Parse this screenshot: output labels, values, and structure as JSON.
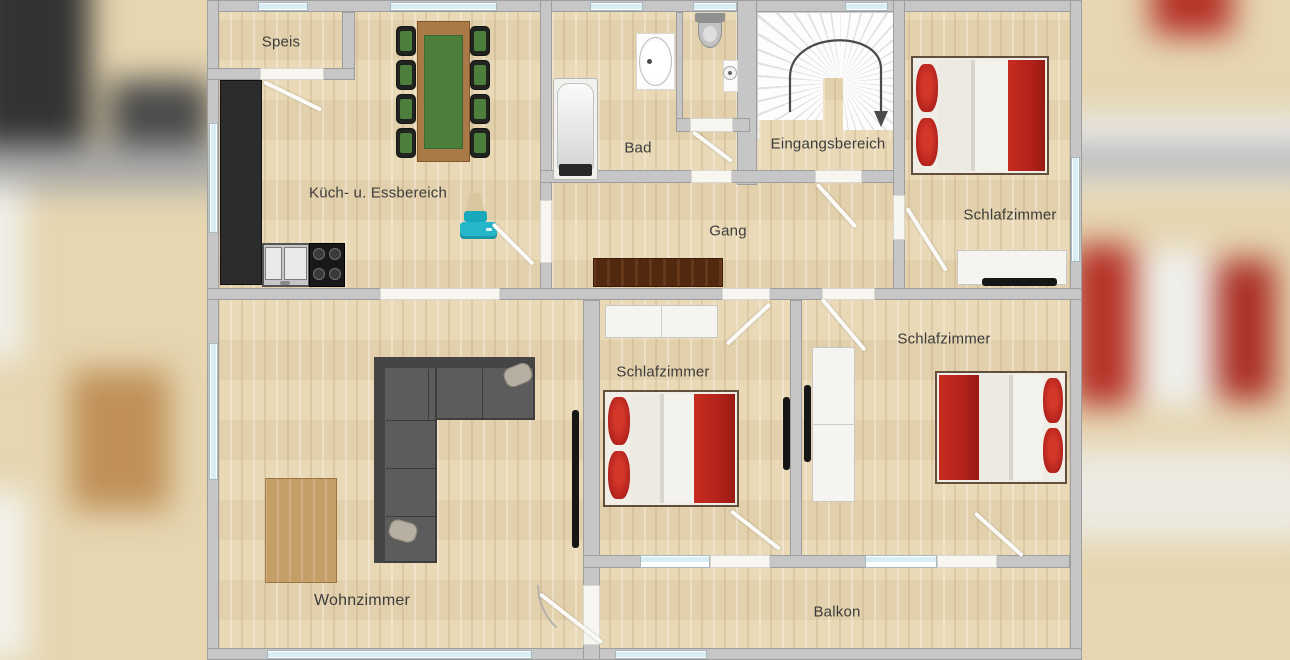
{
  "floorplan": {
    "type": "apartment-floorplan",
    "language": "de",
    "rooms": {
      "speis": {
        "label": "Speis"
      },
      "kitchen": {
        "label": "Küch- u. Essbereich"
      },
      "bad": {
        "label": "Bad"
      },
      "gang": {
        "label": "Gang"
      },
      "entrance": {
        "label": "Eingangsbereich"
      },
      "bedroom_top": {
        "label": "Schlafzimmer"
      },
      "bedroom_middle": {
        "label": "Schlafzimmer"
      },
      "bedroom_right": {
        "label": "Schlafzimmer"
      },
      "living": {
        "label": "Wohnzimmer"
      },
      "balcony": {
        "label": "Balkon"
      }
    },
    "furniture_depicted": [
      "kitchen counter",
      "double sink",
      "stove with 4 burners",
      "dining table with green runner and 8 chairs",
      "teal printer",
      "bathtub",
      "washbasin",
      "toilet",
      "small corner basin",
      "winder staircase with down arrow",
      "dark sideboard",
      "double bed with red pillows and blanket (x3)",
      "white wardrobe (x2)",
      "white dresser with TV",
      "gray corner sofa with two pillows",
      "wooden coffee table",
      "wall-mounted TV (x3)"
    ],
    "colors": {
      "floor_wood": "#e8d7b2",
      "wall": "#c6c6c6",
      "window_glass": "#d9edf5",
      "bed_red": "#b5231d",
      "sofa_gray": "#5c5c5c",
      "table_green": "#4e7e3c",
      "table_wood": "#a97a48",
      "sideboard_brown": "#52280e",
      "printer_teal": "#25b6c9",
      "counter_black": "#2c2c2c",
      "stair_white": "#f7f7f7"
    }
  }
}
